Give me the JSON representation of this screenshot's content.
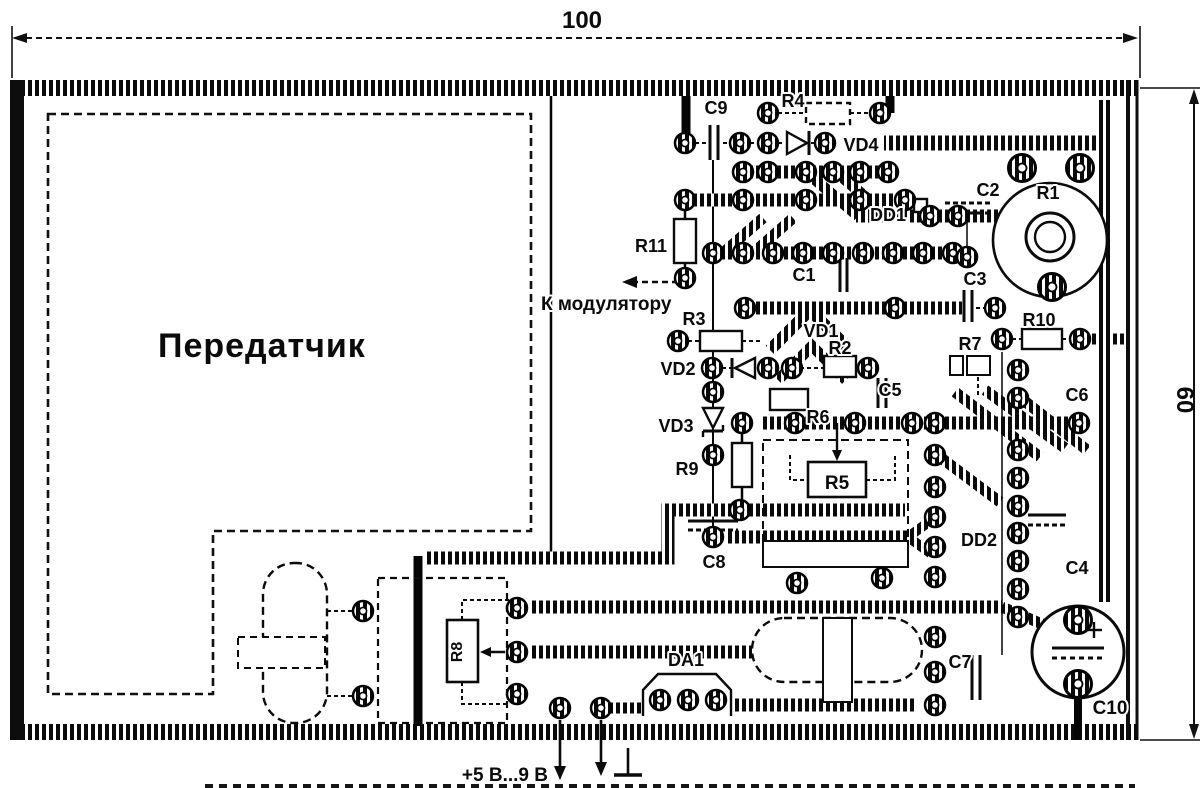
{
  "dimensions": {
    "width": "100",
    "height": "60"
  },
  "texts": {
    "transmitter": "Передатчик",
    "to_modulator": "К модулятору",
    "power": "+5 В...9 В"
  },
  "components": {
    "R1": "R1",
    "R2": "R2",
    "R3": "R3",
    "R4": "R4",
    "R5": "R5",
    "R6": "R6",
    "R7": "R7",
    "R8": "R8",
    "R9": "R9",
    "R10": "R10",
    "R11": "R11",
    "C1": "C1",
    "C2": "C2",
    "C3": "C3",
    "C4": "C4",
    "C5": "C5",
    "C6": "C6",
    "C7": "C7",
    "C8": "C8",
    "C9": "C9",
    "C10": "C10",
    "VD1": "VD1",
    "VD2": "VD2",
    "VD3": "VD3",
    "VD4": "VD4",
    "DD1": "DD1",
    "DD2": "DD2",
    "DA1": "DA1"
  }
}
